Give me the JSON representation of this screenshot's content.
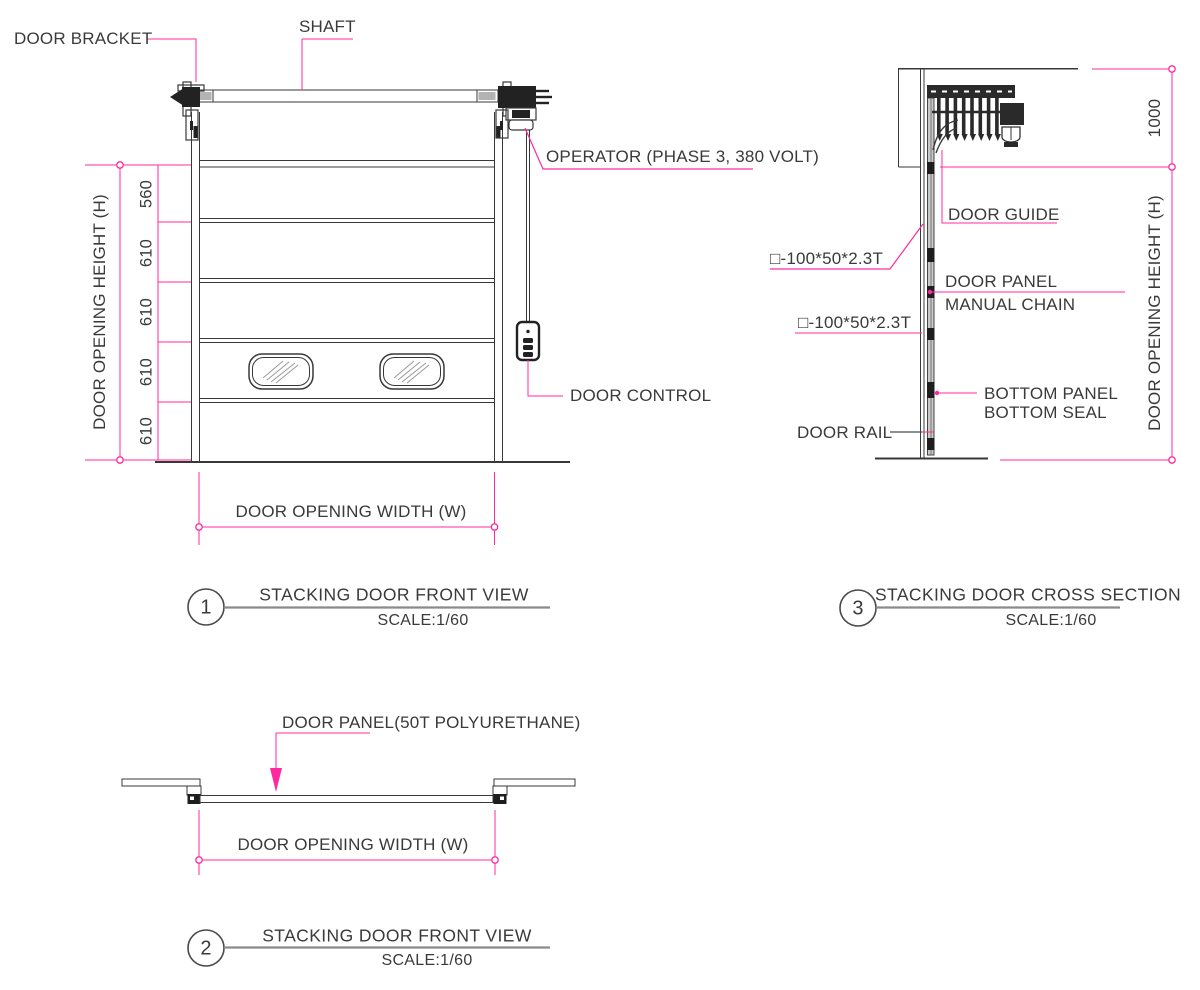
{
  "colors": {
    "accent": "#ff2a9e",
    "ink": "#3a3a3a",
    "line_dark": "#383838",
    "title_line": "#8a8a8a"
  },
  "front_view": {
    "annotations": {
      "door_bracket": "DOOR BRACKET",
      "shaft": "SHAFT",
      "operator": "OPERATOR (PHASE 3, 380 VOLT)",
      "door_control": "DOOR CONTROL"
    },
    "dimensions": {
      "height_label": "DOOR OPENING HEIGHT (H)",
      "width_label": "DOOR OPENING WIDTH (W)",
      "segments": [
        "560",
        "610",
        "610",
        "610",
        "610"
      ]
    },
    "title": {
      "number": "1",
      "name": "STACKING DOOR FRONT VIEW",
      "scale": "SCALE:1/60"
    }
  },
  "cross_section": {
    "annotations": {
      "door_guide": "DOOR GUIDE",
      "square_tube_upper": "□-100*50*2.3T",
      "square_tube_lower": "□-100*50*2.3T",
      "door_panel": "DOOR PANEL",
      "manual_chain": "MANUAL CHAIN",
      "bottom_panel": "BOTTOM PANEL",
      "bottom_seal": "BOTTOM SEAL",
      "door_rail": "DOOR RAIL"
    },
    "dimensions": {
      "header_height": "1000",
      "height_label": "DOOR OPENING HEIGHT (H)"
    },
    "title": {
      "number": "3",
      "name": "STACKING DOOR CROSS SECTION",
      "scale": "SCALE:1/60"
    }
  },
  "plan_view": {
    "annotations": {
      "door_panel": "DOOR PANEL(50T POLYURETHANE)"
    },
    "dimensions": {
      "width_label": "DOOR OPENING WIDTH (W)"
    },
    "title": {
      "number": "2",
      "name": "STACKING DOOR FRONT VIEW",
      "scale": "SCALE:1/60"
    }
  }
}
